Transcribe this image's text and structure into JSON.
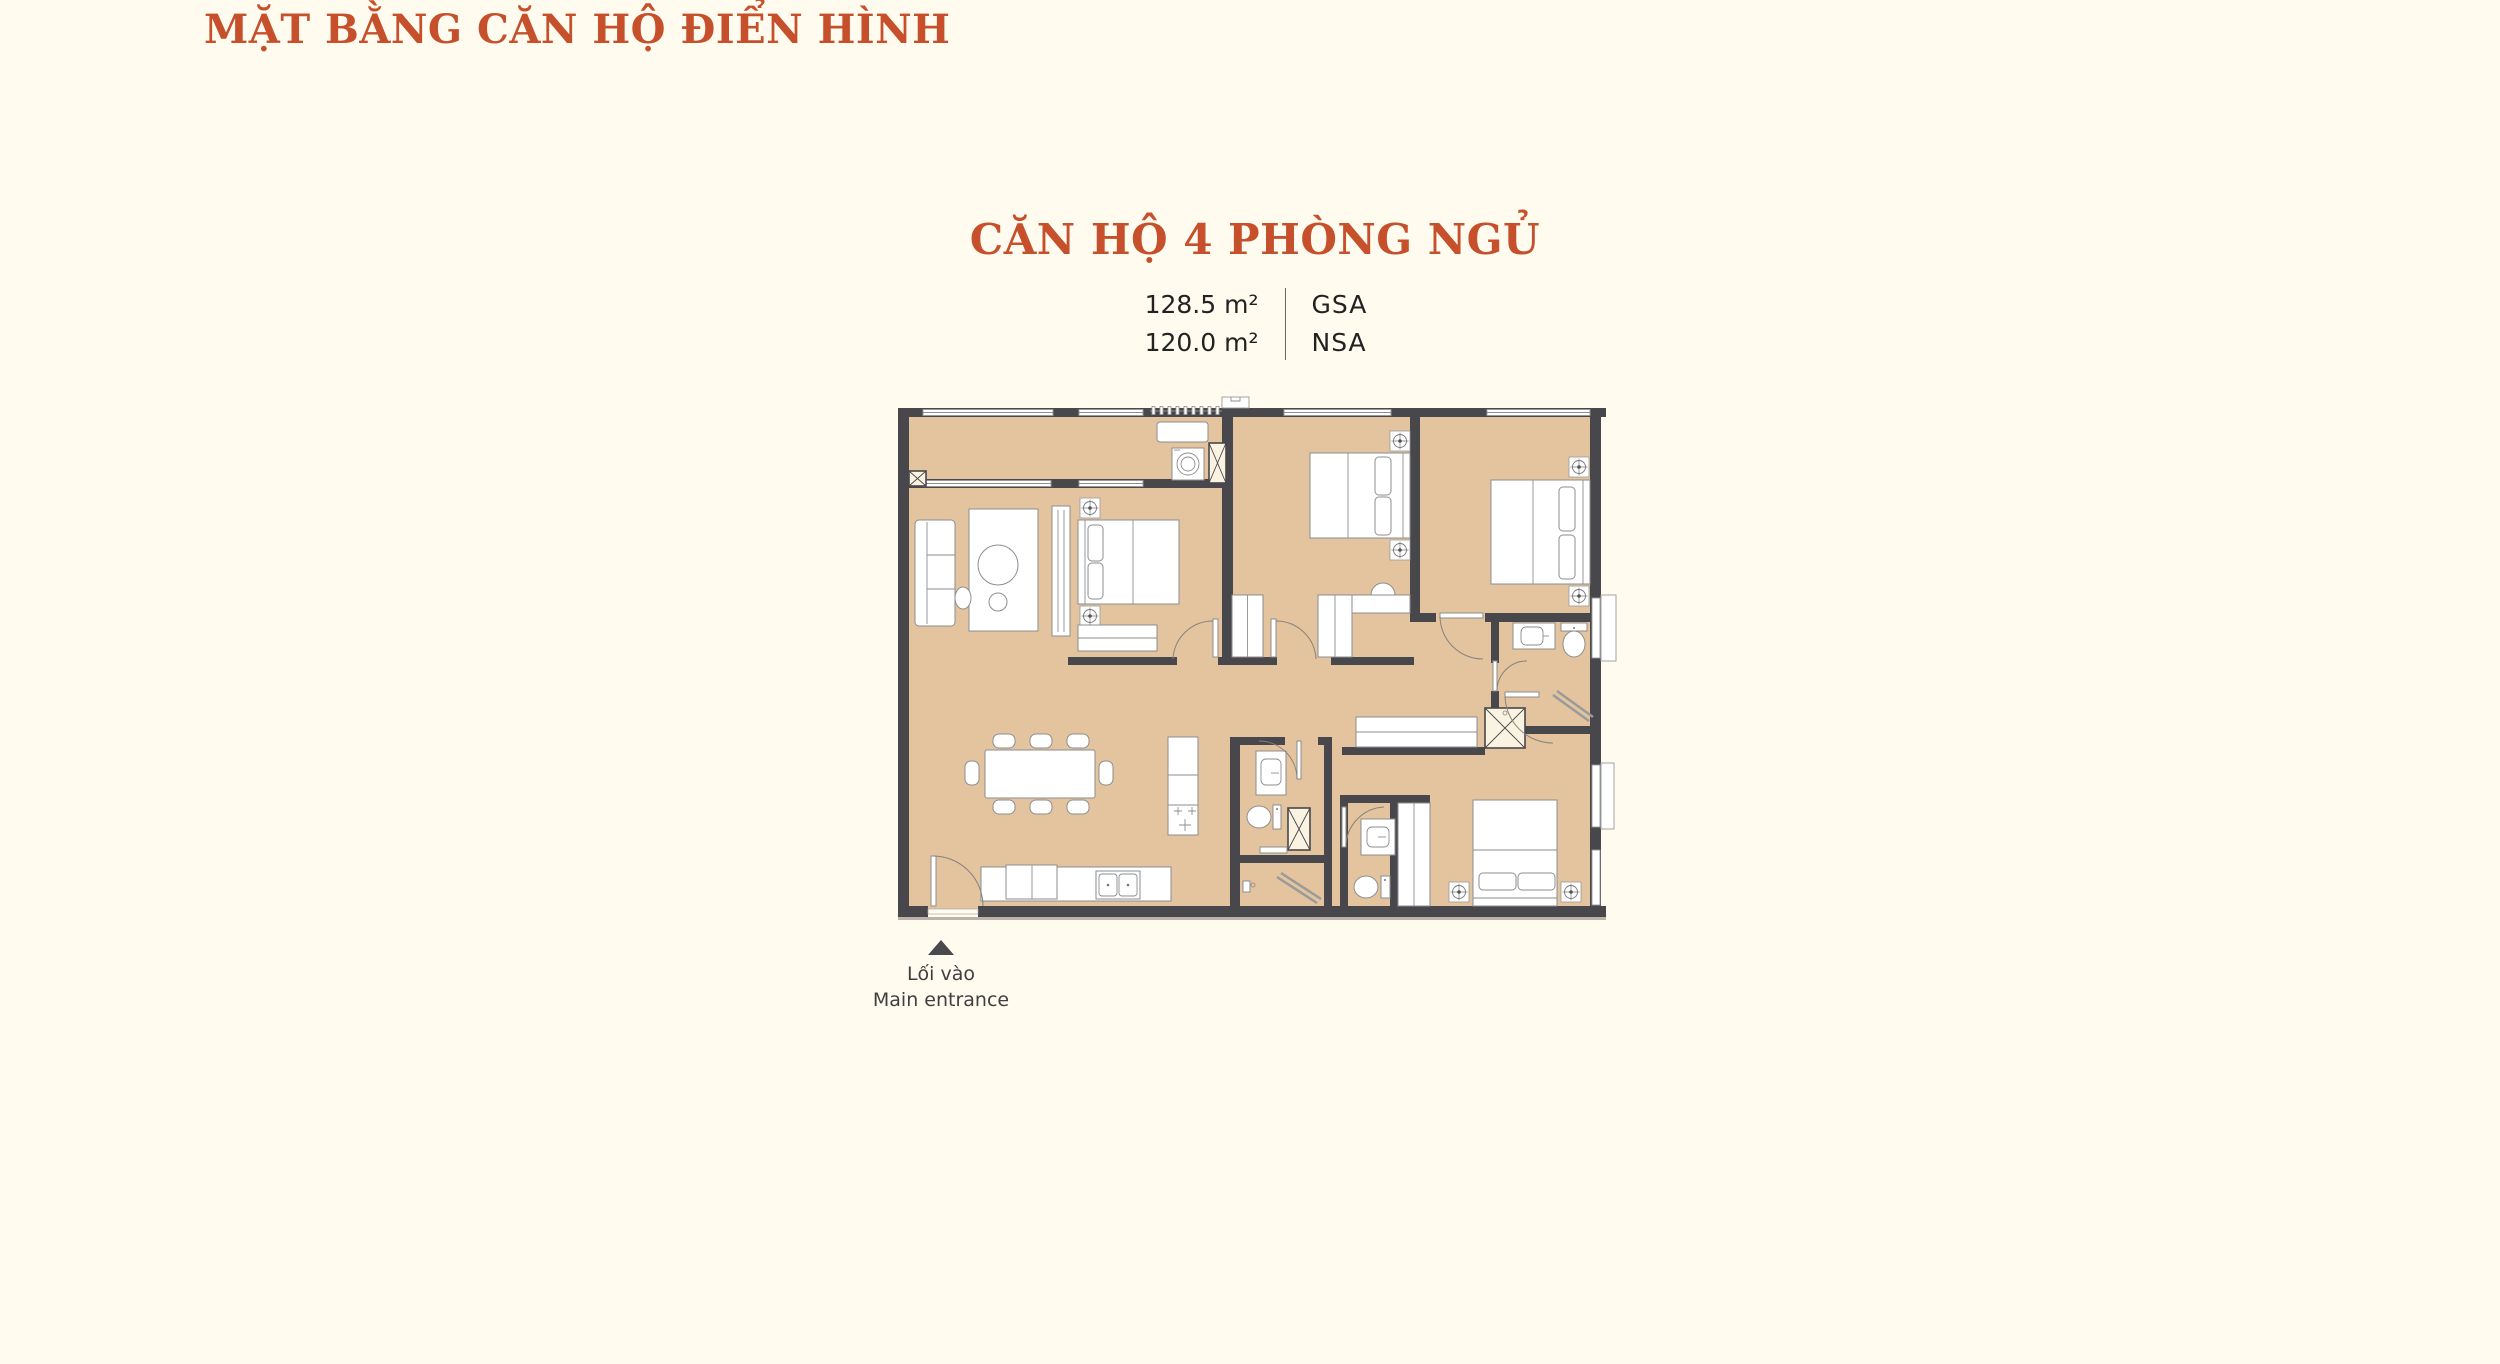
{
  "header": {
    "title": "MẶT BẰNG CĂN HỘ ĐIỂN HÌNH"
  },
  "unit": {
    "title": "CĂN HỘ 4 PHÒNG NGỦ",
    "areas": [
      {
        "value": "128.5 m²",
        "label": "GSA"
      },
      {
        "value": "120.0 m²",
        "label": "NSA"
      }
    ]
  },
  "entrance": {
    "line1": "Lối vào",
    "line2": "Main entrance"
  },
  "floorplan": {
    "type": "apartment-floor-plan",
    "bedrooms": 4
  },
  "colors": {
    "accent": "#C5502B",
    "background": "#FFFBEF",
    "floor": "#E3C49E",
    "wall": "#48474B",
    "furniture_line": "#8E8E8E",
    "text_dark": "#222222",
    "marker": "#4A4A4E"
  }
}
